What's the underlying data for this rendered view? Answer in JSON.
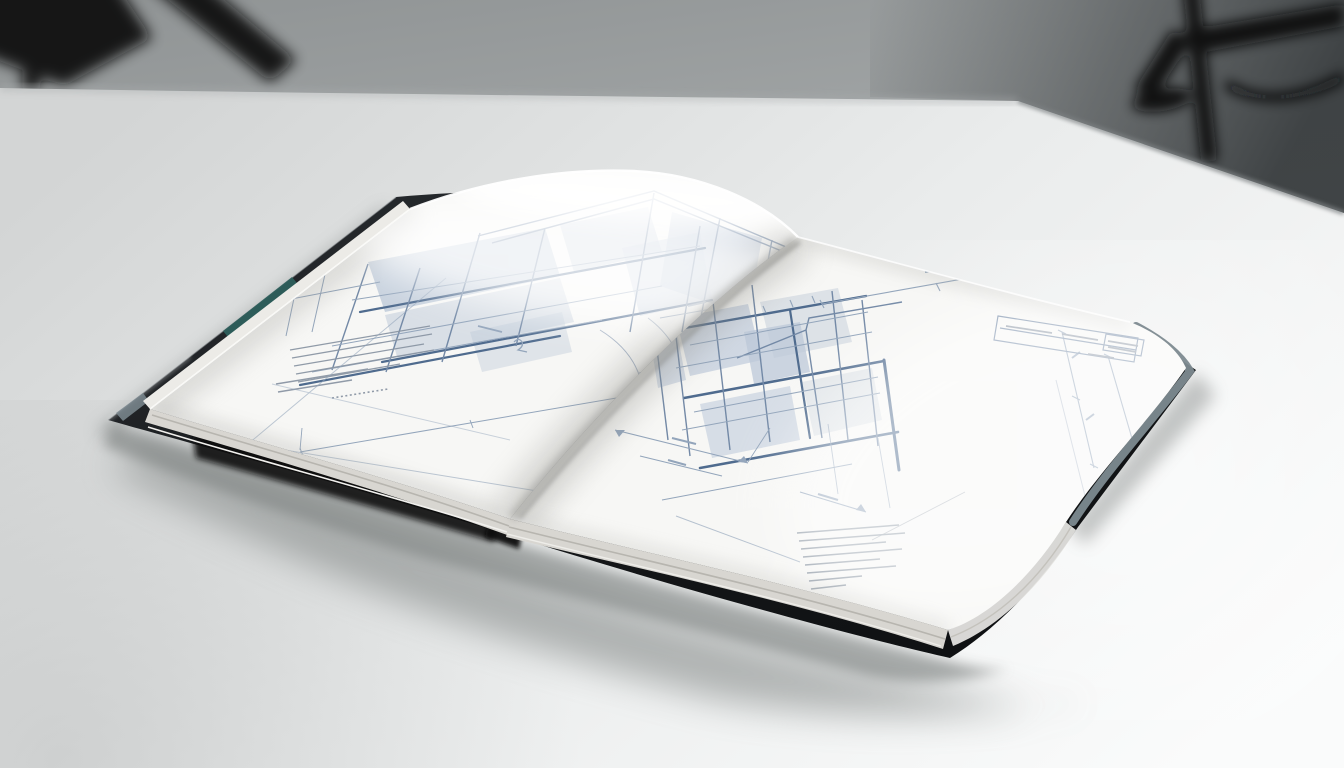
{
  "scene": {
    "description": "Studio photograph of an open hardcover book of architectural blueprint drawings lying on a white seamless table, blurred tripod stands in the grey background, soft shadow cast toward the lower left.",
    "objects": {
      "backdrop": "grey studio wall, out of focus",
      "tripod_left": "blurred black tripod leg, top-left corner",
      "tripod_right": "blurred black tripod with cable, top-right corner",
      "table": "white seamless table surface, brightest at right",
      "book": "open hardcover book with black cover and teal spine accent",
      "left_page": "blueprint elevation of a glazed house with pitched roof, notes and dimension lines",
      "right_page": "blueprint elevation with heavy floor bands, dimension chains, title block and notes",
      "page_edges": "curled stack of page fore-edges",
      "shadow": "soft book shadow spreading to the lower left"
    }
  },
  "book": {
    "cover": "black hardcover",
    "spine_accent": "teal band on spine edge",
    "left_page_features": [
      "house elevation with pitched roof",
      "glazed curtain-wall panels",
      "dimension line below drawing",
      "faint linework near fore edge",
      "fine-print notes paragraph",
      "dotted reference row"
    ],
    "right_page_features": [
      "elevation with heavy slab bands",
      "mullioned glazing grid",
      "top dimension line",
      "two right-hand dimension chains",
      "bottom dimension chains with arrows",
      "title block with dense entries",
      "fine-print notes paragraph"
    ],
    "legible_text": ""
  },
  "colors": {
    "background_top": "#8f9394",
    "background_top_right": "#34383a",
    "table_left": "#d3d5d5",
    "table_right": "#fafbfb",
    "tripod": "#0b0d0e",
    "cover": "#17191b",
    "spine_teal": "#2e5f5c",
    "spine_slate": "#7d8a90",
    "page": "#f7f7f5",
    "page_edge_stack": "#d8d6d1",
    "gutter_shadow": "#8a8a85",
    "blueprint_strong": "#4f6b8e",
    "blueprint_medium": "#7389a6",
    "blueprint_light": "#93a5bb",
    "blueprint_glass": "#bcc8d8",
    "notes_ink": "#8b96a4",
    "book_shadow": "#707473"
  }
}
